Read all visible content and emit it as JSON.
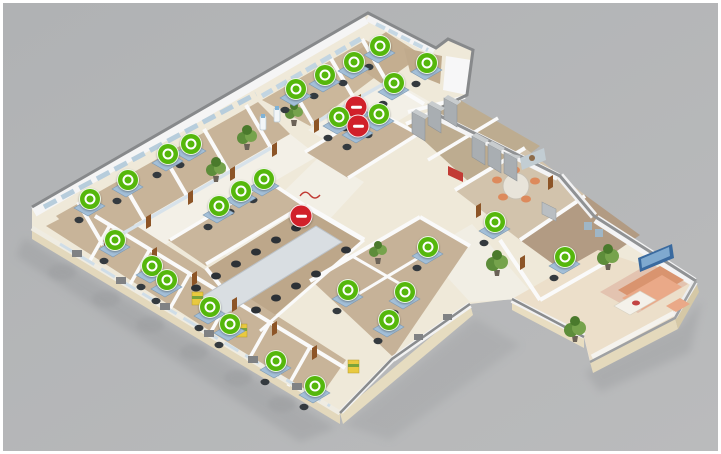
{
  "app": {
    "name": "3d-office-floorplan-viewer"
  },
  "canvas": {
    "width": 721,
    "height": 454,
    "frame_color": "#ffffff",
    "background_top": "#b0b2b4",
    "background_bottom": "#babbbc"
  },
  "marker_styles": {
    "available_color": "#55b70c",
    "occupied_color": "#d1202a",
    "ring_color": "#ffffff"
  },
  "counts": {
    "available": 28,
    "occupied": 3
  },
  "markers": [
    {
      "id": "m01",
      "x": 380,
      "y": 46,
      "status": "available",
      "zone": "top-wing",
      "on_desk": true
    },
    {
      "id": "m02",
      "x": 354,
      "y": 62,
      "status": "available",
      "zone": "top-wing",
      "on_desk": true
    },
    {
      "id": "m03",
      "x": 325,
      "y": 75,
      "status": "available",
      "zone": "top-wing",
      "on_desk": true
    },
    {
      "id": "m04",
      "x": 296,
      "y": 89,
      "status": "available",
      "zone": "top-wing",
      "on_desk": true
    },
    {
      "id": "m05",
      "x": 427,
      "y": 63,
      "status": "available",
      "zone": "top-arm",
      "on_desk": true
    },
    {
      "id": "m06",
      "x": 394,
      "y": 83,
      "status": "available",
      "zone": "top-center",
      "on_desk": true
    },
    {
      "id": "m07",
      "x": 356,
      "y": 107,
      "status": "occupied",
      "zone": "top-center",
      "on_desk": true
    },
    {
      "id": "m08",
      "x": 339,
      "y": 117,
      "status": "available",
      "zone": "top-center",
      "on_desk": true
    },
    {
      "id": "m09",
      "x": 379,
      "y": 114,
      "status": "available",
      "zone": "top-center",
      "on_desk": true
    },
    {
      "id": "m10",
      "x": 358,
      "y": 126,
      "status": "occupied",
      "zone": "top-center",
      "on_desk": true
    },
    {
      "id": "m11",
      "x": 191,
      "y": 144,
      "status": "available",
      "zone": "left-wing",
      "on_desk": true
    },
    {
      "id": "m12",
      "x": 168,
      "y": 154,
      "status": "available",
      "zone": "left-wing",
      "on_desk": true
    },
    {
      "id": "m13",
      "x": 128,
      "y": 180,
      "status": "available",
      "zone": "left-wing",
      "on_desk": true
    },
    {
      "id": "m14",
      "x": 90,
      "y": 199,
      "status": "available",
      "zone": "left-wing",
      "on_desk": true
    },
    {
      "id": "m15",
      "x": 264,
      "y": 179,
      "status": "available",
      "zone": "center-open",
      "on_desk": true
    },
    {
      "id": "m16",
      "x": 241,
      "y": 191,
      "status": "available",
      "zone": "center-open",
      "on_desk": true
    },
    {
      "id": "m17",
      "x": 219,
      "y": 206,
      "status": "available",
      "zone": "center-open",
      "on_desk": true
    },
    {
      "id": "m18",
      "x": 301,
      "y": 216,
      "status": "occupied",
      "zone": "conference-room",
      "on_desk": false
    },
    {
      "id": "m19",
      "x": 115,
      "y": 240,
      "status": "available",
      "zone": "bottom-wing",
      "on_desk": true
    },
    {
      "id": "m20",
      "x": 152,
      "y": 266,
      "status": "available",
      "zone": "bottom-wing",
      "on_desk": true
    },
    {
      "id": "m21",
      "x": 167,
      "y": 280,
      "status": "available",
      "zone": "bottom-wing",
      "on_desk": true
    },
    {
      "id": "m22",
      "x": 210,
      "y": 307,
      "status": "available",
      "zone": "bottom-wing",
      "on_desk": true
    },
    {
      "id": "m23",
      "x": 230,
      "y": 324,
      "status": "available",
      "zone": "bottom-wing",
      "on_desk": true
    },
    {
      "id": "m24",
      "x": 276,
      "y": 361,
      "status": "available",
      "zone": "bottom-wing",
      "on_desk": true
    },
    {
      "id": "m25",
      "x": 315,
      "y": 386,
      "status": "available",
      "zone": "bottom-wing",
      "on_desk": true
    },
    {
      "id": "m26",
      "x": 348,
      "y": 290,
      "status": "available",
      "zone": "bottom-center",
      "on_desk": true
    },
    {
      "id": "m27",
      "x": 405,
      "y": 292,
      "status": "available",
      "zone": "bottom-center",
      "on_desk": true
    },
    {
      "id": "m28",
      "x": 389,
      "y": 320,
      "status": "available",
      "zone": "bottom-center",
      "on_desk": true
    },
    {
      "id": "m29",
      "x": 428,
      "y": 247,
      "status": "available",
      "zone": "bottom-center",
      "on_desk": true
    },
    {
      "id": "m30",
      "x": 495,
      "y": 222,
      "status": "available",
      "zone": "right-offices",
      "on_desk": true
    },
    {
      "id": "m31",
      "x": 565,
      "y": 257,
      "status": "available",
      "zone": "right-offices",
      "on_desk": true
    }
  ]
}
